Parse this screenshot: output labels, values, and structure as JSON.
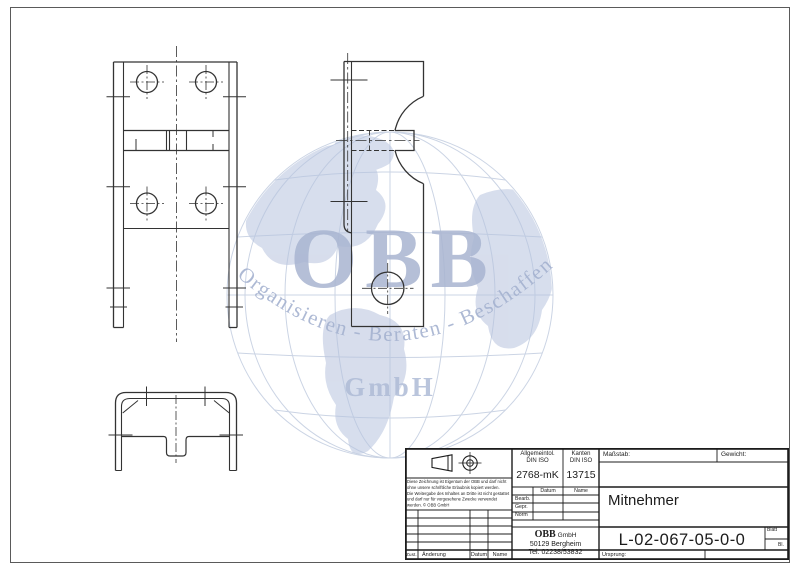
{
  "watermark": {
    "company": "OBB",
    "tagline": "Organisieren - Beraten - Beschaffen",
    "suffix": "GmbH",
    "color": "#a9b5d1",
    "grid_color": "#c6d0e2"
  },
  "drawing": {
    "line_color": "#333333",
    "views": [
      "front-view",
      "side-view",
      "profile-view"
    ]
  },
  "title_block": {
    "general_tolerance": {
      "label_line1": "Allgemeintol.",
      "label_line2": "DIN ISO",
      "value": "2768-mK"
    },
    "edges": {
      "label_line1": "Kanten",
      "label_line2": "DIN ISO",
      "value": "13715"
    },
    "scale_label": "Maßstab:",
    "weight_label": "Gewicht:",
    "part_name": "Mitnehmer",
    "approval": {
      "date_header": "Datum",
      "name_header": "Name",
      "rows": [
        "Bearb.",
        "Gepr.",
        "Norm"
      ]
    },
    "company": {
      "name": "OBB",
      "suffix": "GmbH",
      "address": "50129 Bergheim",
      "phone": "Tel. 02238/53832"
    },
    "drawing_number": "L-02-067-05-0-0",
    "sheet_label": "Blatt",
    "sheet_abbrev": "Bl.",
    "origin_label": "Ursprung:",
    "revision": {
      "state": "Zust.",
      "change": "Änderung",
      "date": "Datum",
      "name": "Name"
    },
    "disclaimer_lines": [
      "Diese Zeichnung ist Eigentum der OBB und darf nicht",
      "ohne unsere schriftliche Erlaubnis kopiert werden.",
      "Die Weitergabe des Inhaltes an Dritte ist nicht gestattet",
      "und darf nur für vorgesehene Zwecke verwendet",
      "werden. © OBB GmbH"
    ]
  }
}
